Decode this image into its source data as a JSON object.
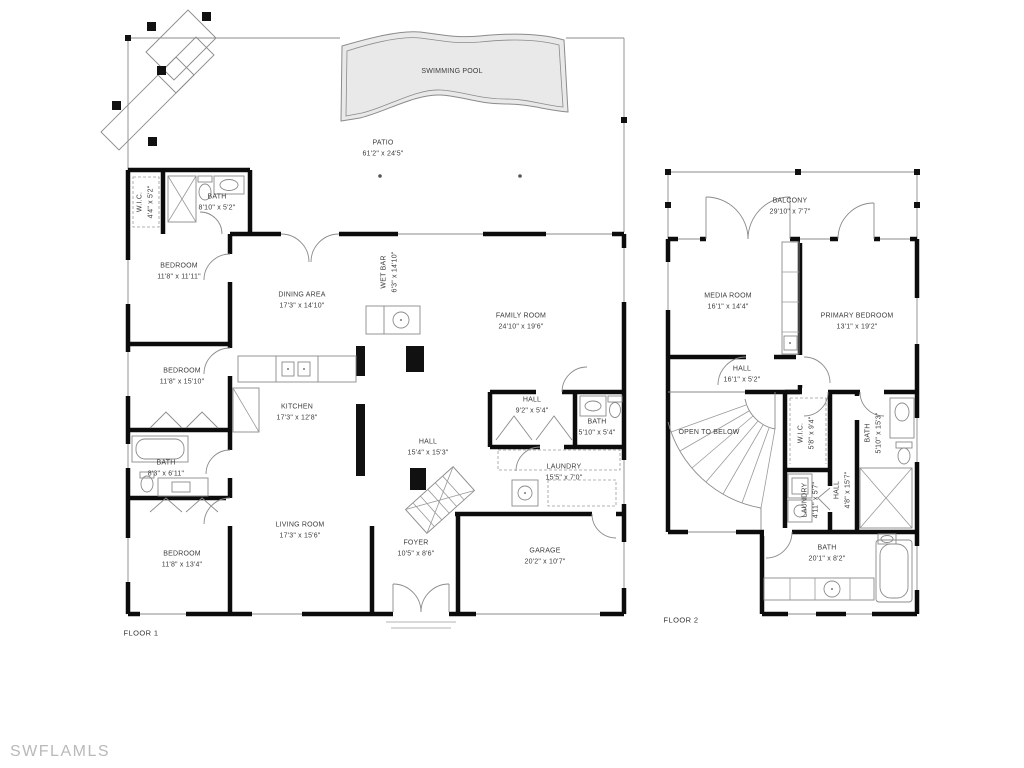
{
  "watermark": "SWFLAMLS",
  "colors": {
    "wall": "#0c0c0c",
    "thin_line": "#8b8b8b",
    "pool_fill": "#e9e9e9",
    "watermark": "#b9b9b9"
  },
  "floor1": {
    "label": "FLOOR 1",
    "rooms": [
      {
        "name": "SWIMMING POOL",
        "dims": ""
      },
      {
        "name": "PATIO",
        "dims": "61'2\" x 24'5\""
      },
      {
        "name": "W.I.C.",
        "dims": "4'4\" x 5'2\""
      },
      {
        "name": "BATH",
        "dims": "8'10\" x 5'2\""
      },
      {
        "name": "BEDROOM",
        "dims": "11'8\" x 11'11\""
      },
      {
        "name": "DINING AREA",
        "dims": "17'3\" x 14'10\""
      },
      {
        "name": "WET BAR",
        "dims": "6'3\" x 14'10\""
      },
      {
        "name": "FAMILY ROOM",
        "dims": "24'10\" x 19'6\""
      },
      {
        "name": "BEDROOM",
        "dims": "11'8\" x 15'10\""
      },
      {
        "name": "KITCHEN",
        "dims": "17'3\" x 12'8\""
      },
      {
        "name": "HALL",
        "dims": "9'2\" x 5'4\""
      },
      {
        "name": "BATH",
        "dims": "5'10\" x 5'4\""
      },
      {
        "name": "BATH",
        "dims": "8'3\" x 6'11\""
      },
      {
        "name": "HALL",
        "dims": "15'4\" x 15'3\""
      },
      {
        "name": "LAUNDRY",
        "dims": "15'5\" x 7'0\""
      },
      {
        "name": "LIVING ROOM",
        "dims": "17'3\" x 15'6\""
      },
      {
        "name": "FOYER",
        "dims": "10'5\" x 8'6\""
      },
      {
        "name": "GARAGE",
        "dims": "20'2\" x 10'7\""
      },
      {
        "name": "BEDROOM",
        "dims": "11'8\" x 13'4\""
      }
    ]
  },
  "floor2": {
    "label": "FLOOR 2",
    "rooms": [
      {
        "name": "BALCONY",
        "dims": "29'10\" x 7'7\""
      },
      {
        "name": "MEDIA ROOM",
        "dims": "16'1\" x 14'4\""
      },
      {
        "name": "PRIMARY BEDROOM",
        "dims": "13'1\" x 19'2\""
      },
      {
        "name": "HALL",
        "dims": "16'1\" x 5'2\""
      },
      {
        "name": "OPEN TO BELOW",
        "dims": ""
      },
      {
        "name": "W.I.C.",
        "dims": "5'8\" x 9'4\""
      },
      {
        "name": "BATH",
        "dims": "5'10\" x 15'3\""
      },
      {
        "name": "LAUNDRY",
        "dims": "4'11\" x 5'7\""
      },
      {
        "name": "HALL",
        "dims": "4'8\" x 15'7\""
      },
      {
        "name": "BATH",
        "dims": "20'1\" x 8'2\""
      }
    ]
  }
}
